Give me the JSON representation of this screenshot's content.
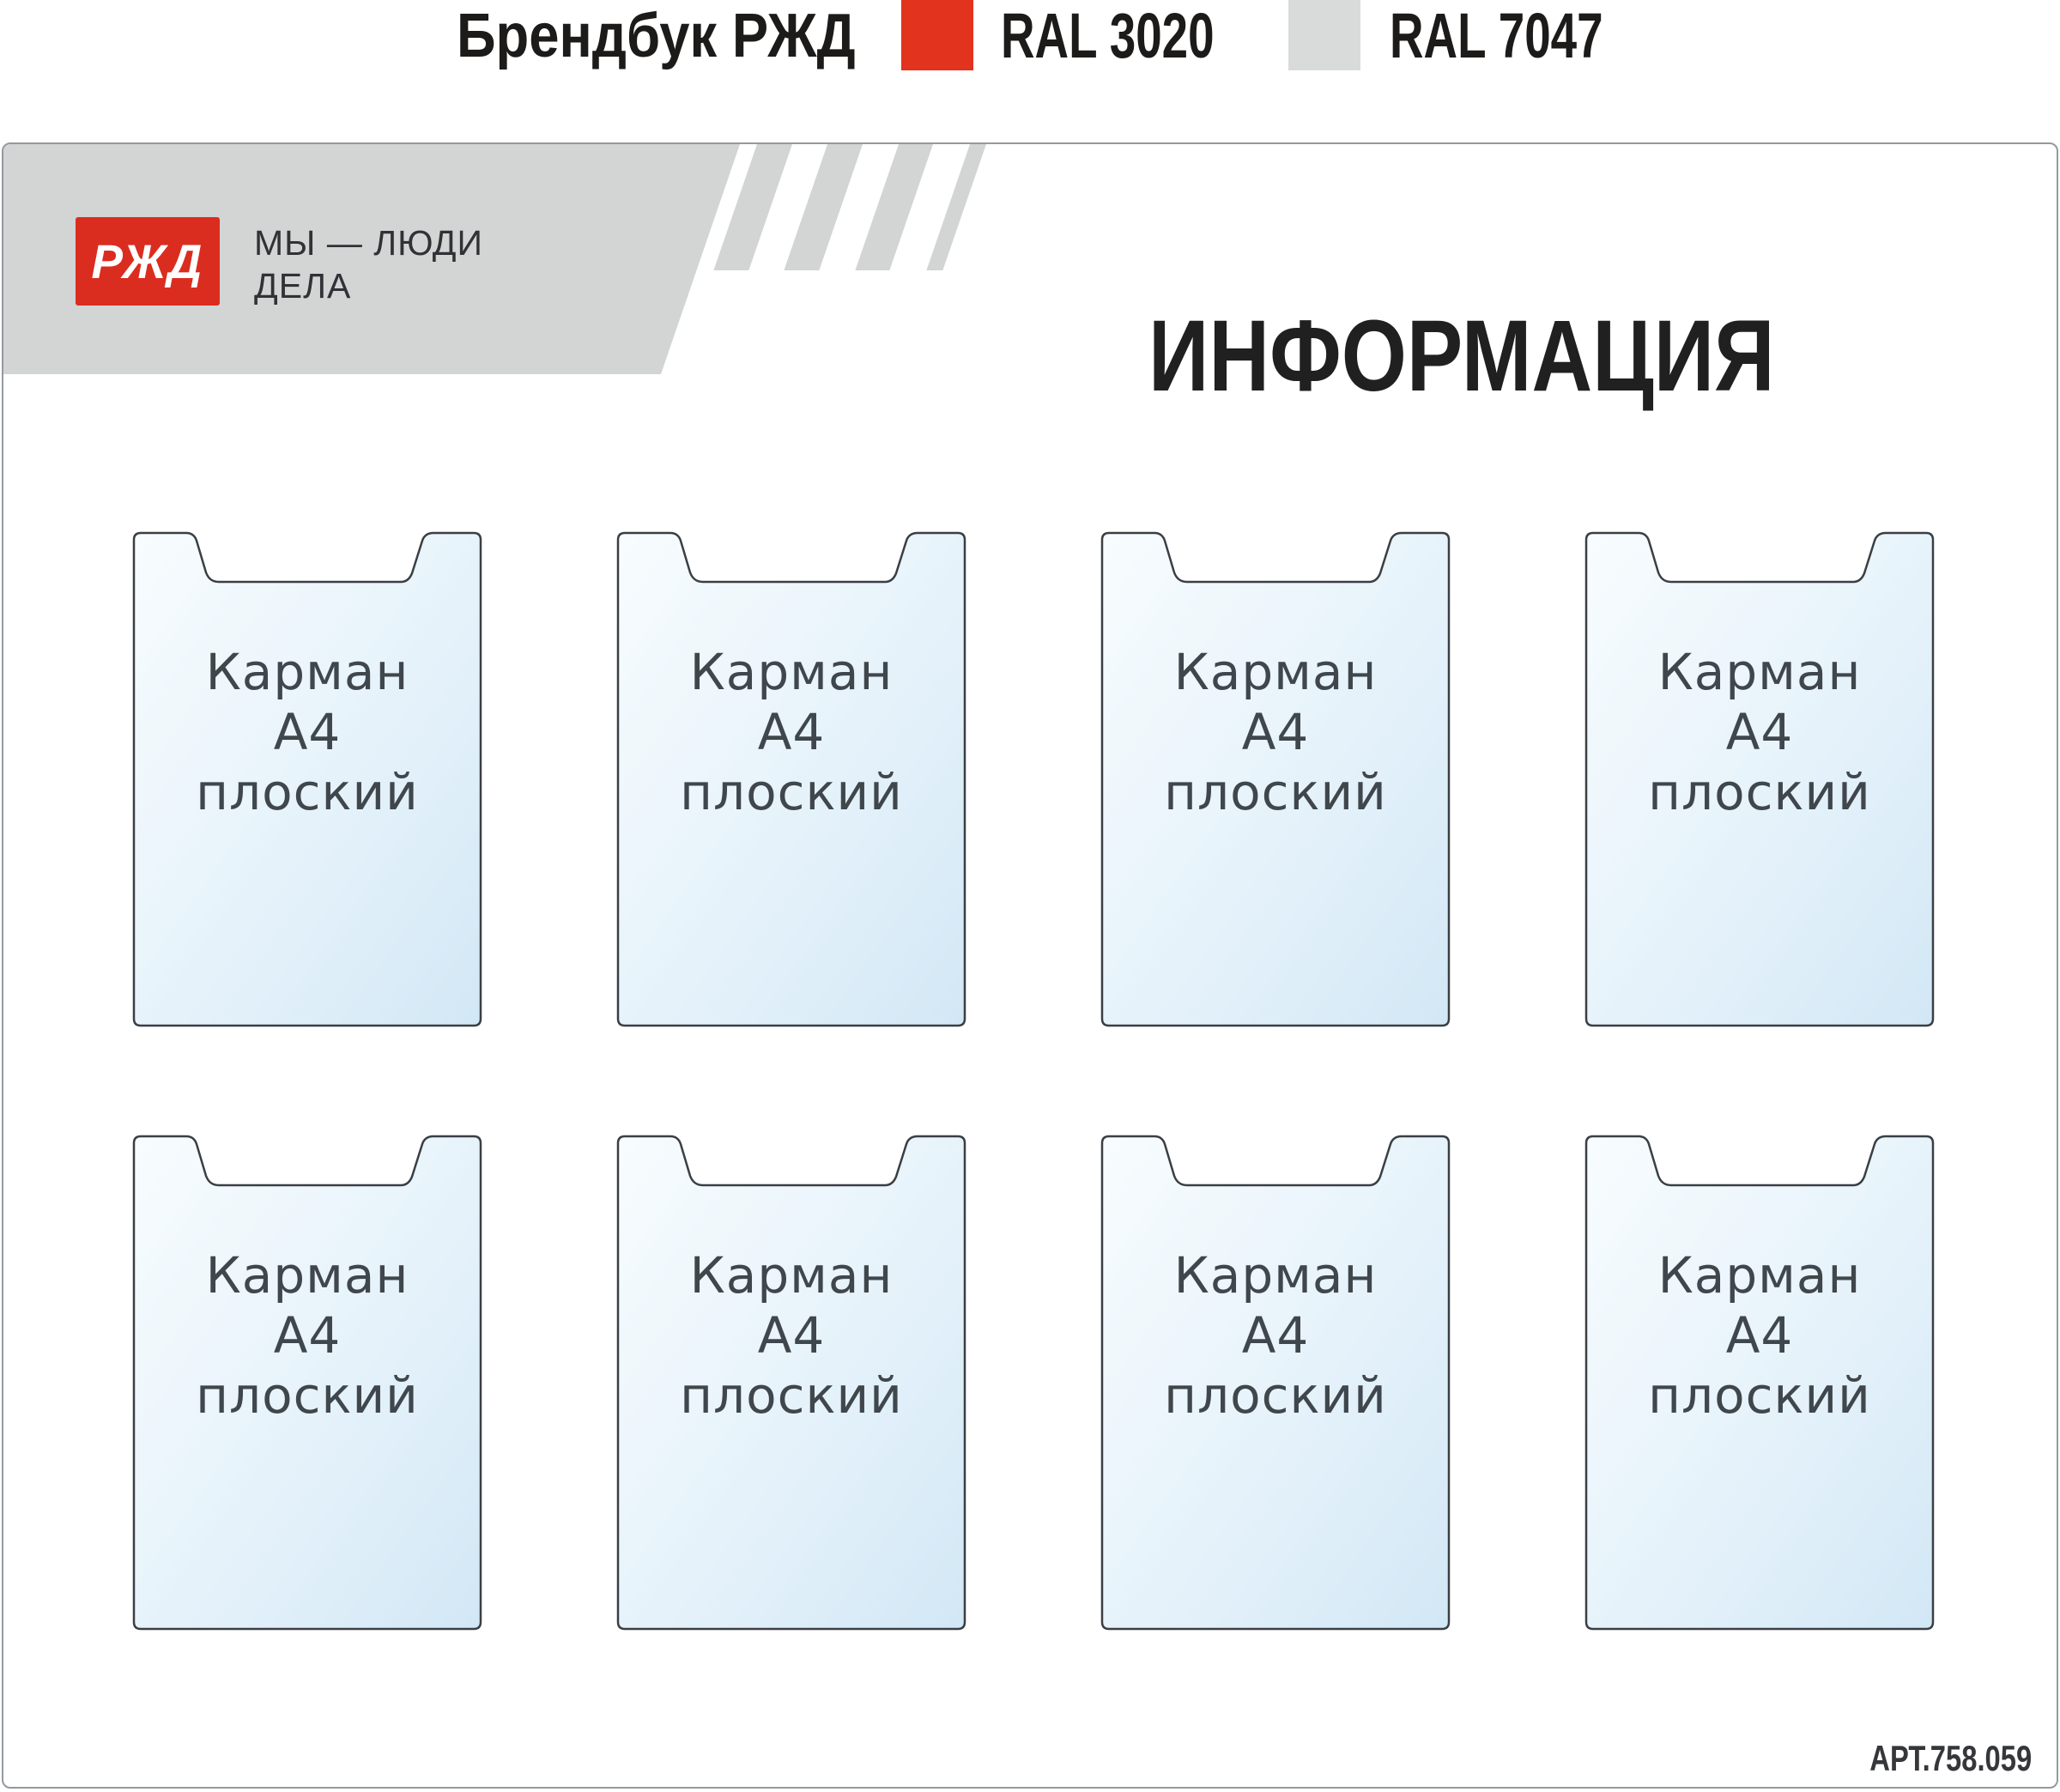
{
  "spec_bar": {
    "brandbook_label": "Брендбук РЖД",
    "swatches": [
      {
        "label": "RAL 3020",
        "color": "#e2331f"
      },
      {
        "label": "RAL 7047",
        "color": "#d9dbda"
      }
    ]
  },
  "board": {
    "logo": {
      "text": "РЖД",
      "color": "#da2d1f"
    },
    "tagline": {
      "line1": "МЫ — ЛЮДИ",
      "line2": "ДЕЛА"
    },
    "title": "ИНФОРМАЦИЯ",
    "article_number": "АРТ.758.059",
    "banner_color": "#d2d5d4",
    "pocket_outline_color": "#3a3f44",
    "pocket_fill_top": "#f8fcfe",
    "pocket_fill_bottom": "#d2e7f5",
    "pockets": [
      {
        "lines": [
          "Карман",
          "А4",
          "плоский"
        ]
      },
      {
        "lines": [
          "Карман",
          "А4",
          "плоский"
        ]
      },
      {
        "lines": [
          "Карман",
          "А4",
          "плоский"
        ]
      },
      {
        "lines": [
          "Карман",
          "А4",
          "плоский"
        ]
      },
      {
        "lines": [
          "Карман",
          "А4",
          "плоский"
        ]
      },
      {
        "lines": [
          "Карман",
          "А4",
          "плоский"
        ]
      },
      {
        "lines": [
          "Карман",
          "А4",
          "плоский"
        ]
      },
      {
        "lines": [
          "Карман",
          "А4",
          "плоский"
        ]
      }
    ]
  }
}
